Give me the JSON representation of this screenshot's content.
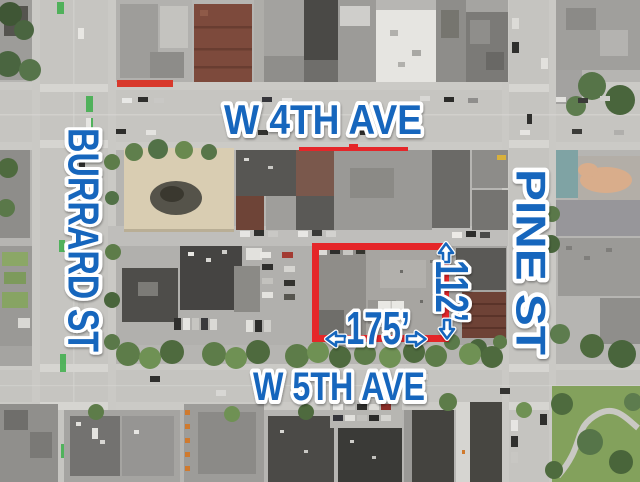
{
  "street_labels": {
    "w4th": "W 4TH AVE",
    "w5th": "W 5TH AVE",
    "burrard": "BURRARD ST",
    "pine": "PINE ST"
  },
  "site": {
    "frontage": "175’",
    "depth": "112’"
  },
  "colors": {
    "label_blue": "#1866bd",
    "halo_white": "#ffffff",
    "site_outline_red": "#e52629"
  },
  "icons": {
    "frontage_left": "arrow-left-icon",
    "frontage_right": "arrow-right-icon",
    "depth_up": "arrow-up-icon",
    "depth_down": "arrow-down-icon"
  }
}
